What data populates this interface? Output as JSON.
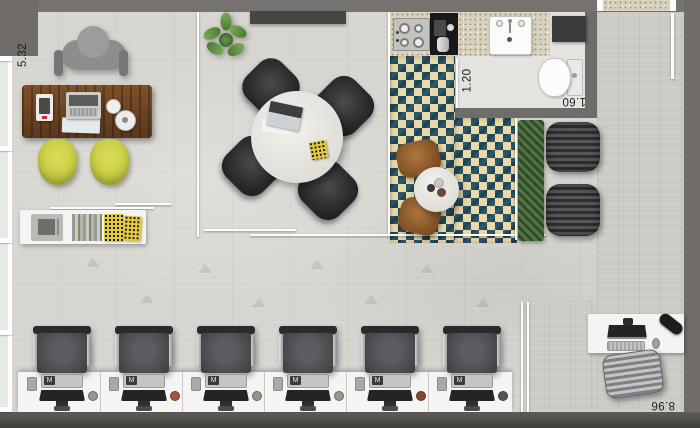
{
  "floor_plan": {
    "labels": {
      "office_width": "5.32",
      "wc_width": "1.20",
      "wc_depth": "1.60",
      "open_area_width": "8.96"
    },
    "workstations": {
      "count": 6,
      "keyboard_badge": "M"
    },
    "palette": {
      "wall": "#6f6c69",
      "floor_concrete": "#d6d5d0",
      "floor_wood": "#cccac4",
      "tile_teal": "#2d5766",
      "tile_cream": "#e9d9ab",
      "chair_yellow": "#c8cd45",
      "desk_wood": "#6c4424",
      "hedge_green": "#3c5a31",
      "accent_box_yellow": "#e4ca3f"
    }
  }
}
